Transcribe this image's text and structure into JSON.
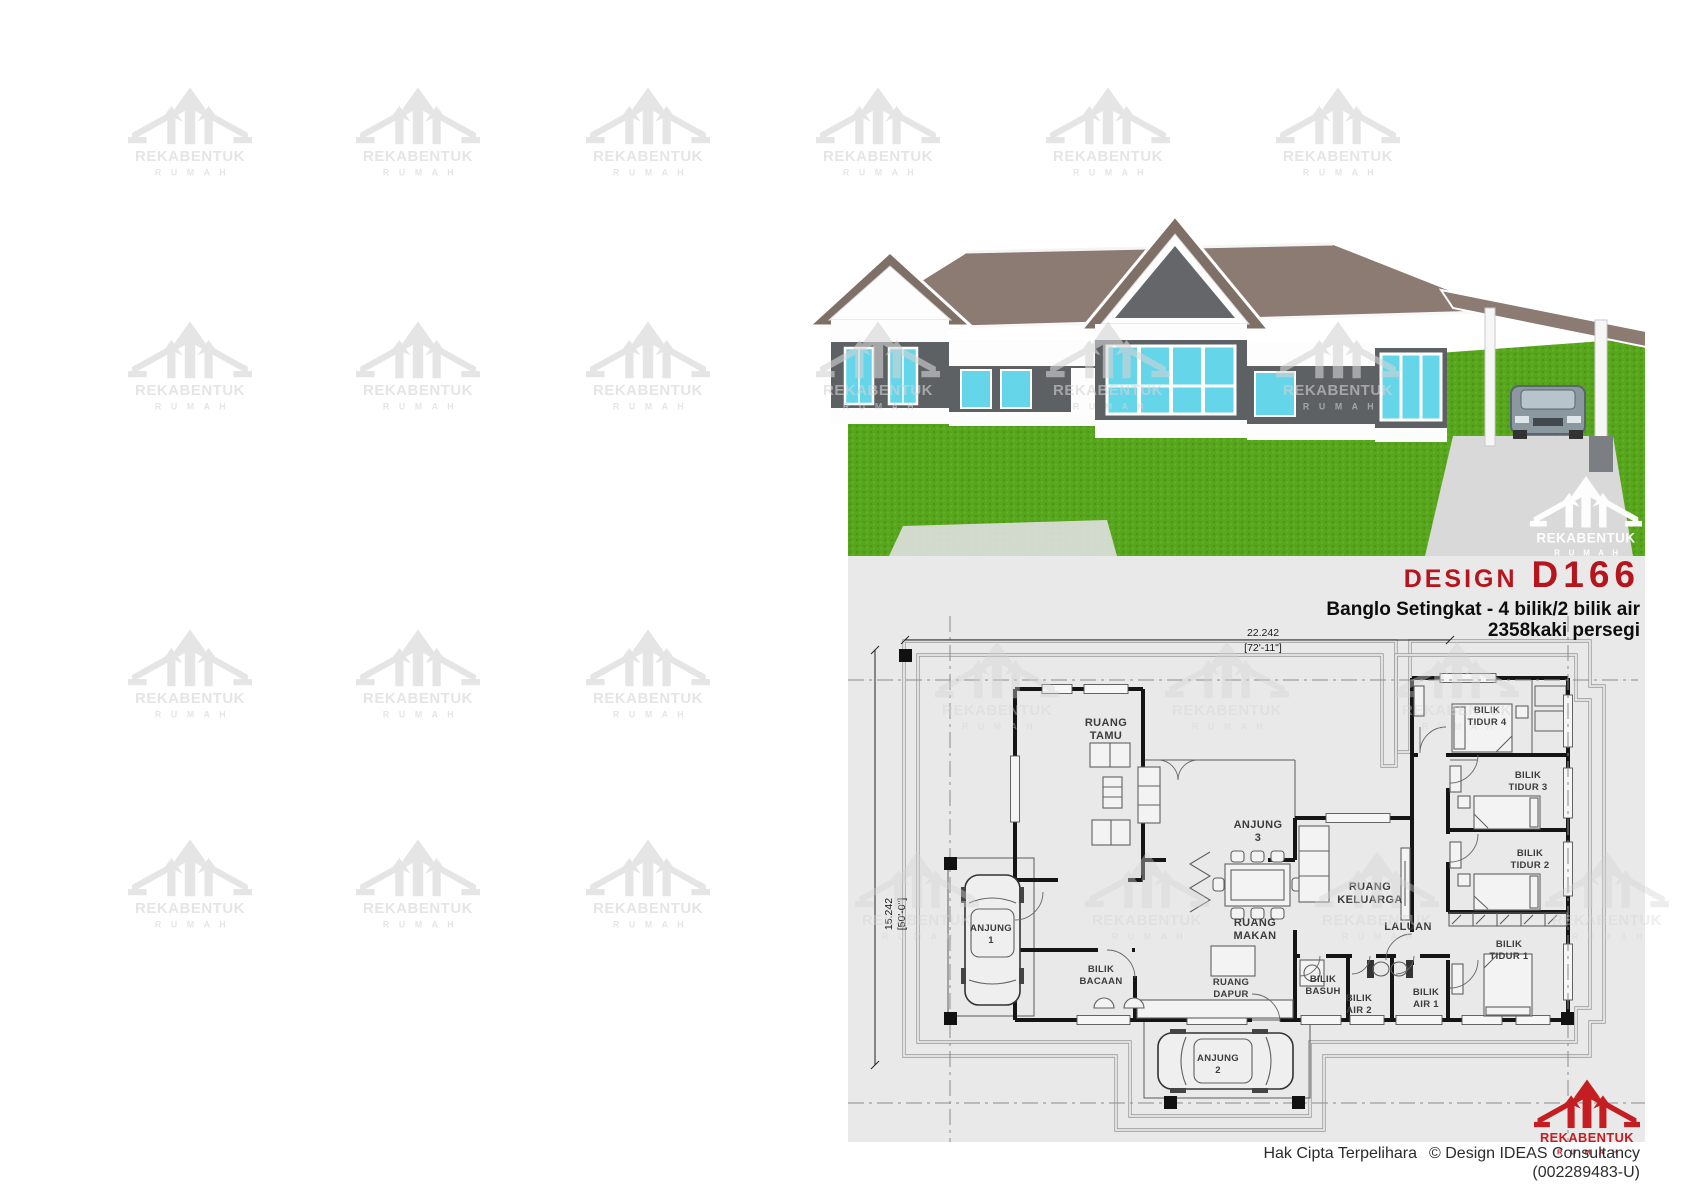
{
  "brand": {
    "name": "REKABENTUK",
    "sub": "R U M A H"
  },
  "title": {
    "design_label": "DESIGN",
    "design_code": "D166",
    "subtitle": "Banglo Setingkat - 4 bilik/2 bilik air",
    "area": "2358kaki persegi"
  },
  "dims": {
    "w_m": "22.242",
    "w_ft": "[72'-11\"]",
    "d_m": "15.242",
    "d_ft": "[50'-0\"]"
  },
  "rooms": {
    "tamu1": "RUANG",
    "tamu2": "TAMU",
    "anj3a": "ANJUNG",
    "anj3b": "3",
    "makan1": "RUANG",
    "makan2": "MAKAN",
    "kel1": "RUANG",
    "kel2": "KELUARGA",
    "laluan": "LALUAN",
    "bt4a": "BILIK",
    "bt4b": "TIDUR 4",
    "bt3a": "BILIK",
    "bt3b": "TIDUR 3",
    "bt2a": "BILIK",
    "bt2b": "TIDUR 2",
    "bt1a": "BILIK",
    "bt1b": "TIDUR 1",
    "bac1": "BILIK",
    "bac2": "BACAAN",
    "dap1": "RUANG",
    "dap2": "DAPUR",
    "bas1": "BILIK",
    "bas2": "BASUH",
    "air2a": "BILIK",
    "air2b": "AIR 2",
    "air1a": "BILIK",
    "air1b": "AIR 1",
    "anj1a": "ANJUNG",
    "anj1b": "1",
    "anj2a": "ANJUNG",
    "anj2b": "2"
  },
  "footer": {
    "copyright_label": "Hak Cipta Terpelihara",
    "company": "© Design IDEAS Consultancy",
    "reg": "(002289483-U)"
  },
  "colors": {
    "accent_red": "#b5161d",
    "logo_red": "#c41d22",
    "grass_green": "#58a51e",
    "roof_taupe": "#8b7b73",
    "wall_dark": "#5e6164",
    "window_cyan": "#65d6ea",
    "plan_bg": "#e9e9e9",
    "watermark_gray": "#d4d4d4"
  }
}
